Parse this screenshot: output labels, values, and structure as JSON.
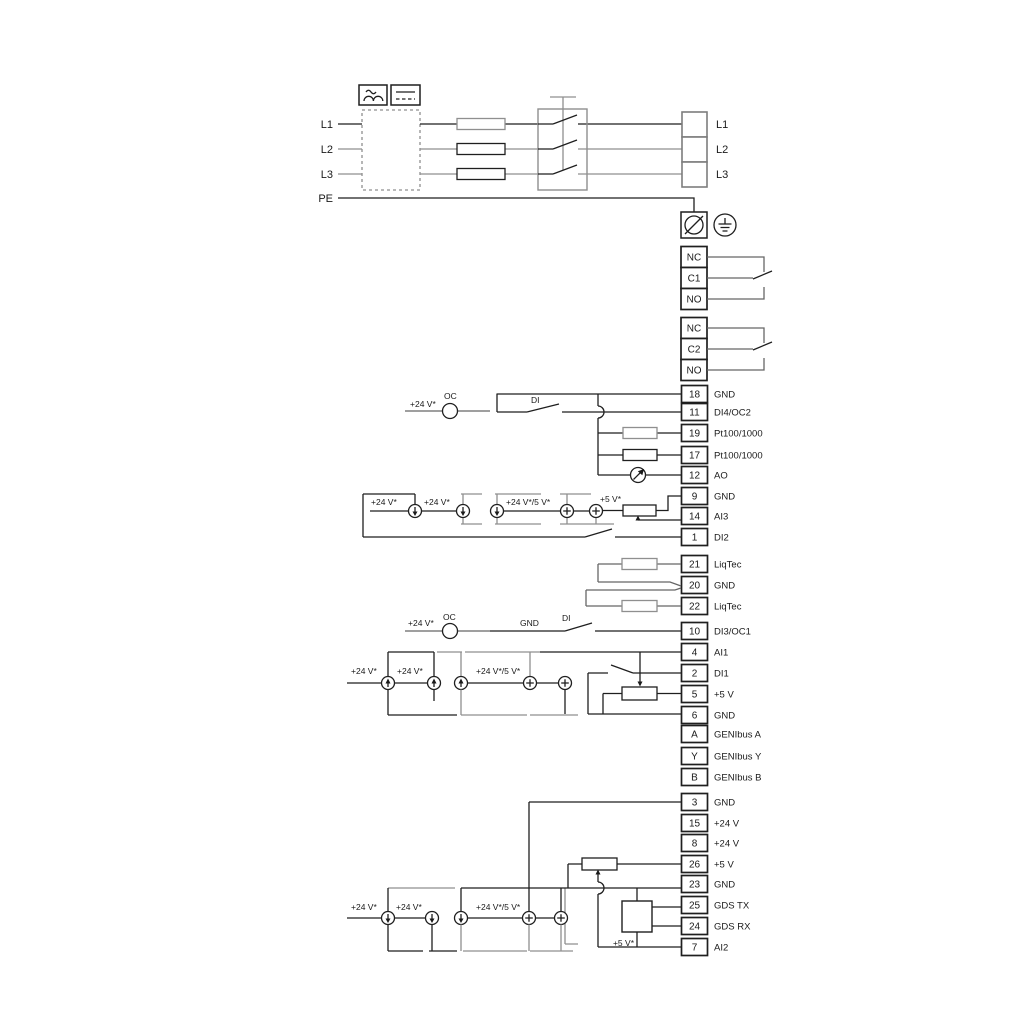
{
  "power": {
    "left_labels": [
      "L1",
      "L2",
      "L3",
      "PE"
    ],
    "right_labels": [
      "L1",
      "L2",
      "L3"
    ]
  },
  "relays": [
    {
      "rows": [
        "NC",
        "C1",
        "NO"
      ]
    },
    {
      "rows": [
        "NC",
        "C2",
        "NO"
      ]
    }
  ],
  "terminals": {
    "group1": [
      {
        "num": "18",
        "label": "GND"
      },
      {
        "num": "11",
        "label": "DI4/OC2"
      },
      {
        "num": "19",
        "label": "Pt100/1000"
      },
      {
        "num": "17",
        "label": "Pt100/1000"
      },
      {
        "num": "12",
        "label": "AO"
      },
      {
        "num": "9",
        "label": "GND"
      },
      {
        "num": "14",
        "label": "AI3"
      },
      {
        "num": "1",
        "label": "DI2"
      }
    ],
    "liqtec": [
      {
        "num": "21",
        "label": "LiqTec"
      },
      {
        "num": "20",
        "label": "GND"
      },
      {
        "num": "22",
        "label": "LiqTec"
      }
    ],
    "io": [
      {
        "num": "10",
        "label": "DI3/OC1"
      },
      {
        "num": "4",
        "label": "AI1"
      },
      {
        "num": "2",
        "label": "DI1"
      },
      {
        "num": "5",
        "label": "+5 V"
      },
      {
        "num": "6",
        "label": "GND"
      },
      {
        "num": "A",
        "label": "GENIbus A"
      },
      {
        "num": "Y",
        "label": "GENIbus Y"
      },
      {
        "num": "B",
        "label": "GENIbus B"
      }
    ],
    "bottom": [
      {
        "num": "3",
        "label": "GND"
      },
      {
        "num": "15",
        "label": "+24 V"
      },
      {
        "num": "8",
        "label": "+24 V"
      },
      {
        "num": "26",
        "label": "+5 V"
      },
      {
        "num": "23",
        "label": "GND"
      },
      {
        "num": "25",
        "label": "GDS TX"
      },
      {
        "num": "24",
        "label": "GDS RX"
      },
      {
        "num": "7",
        "label": "AI2"
      }
    ]
  },
  "ann": {
    "v24": "+24 V*",
    "v245": "+24 V*/5 V*",
    "v5": "+5 V*",
    "oc": "OC",
    "di": "DI",
    "gnd": "GND"
  }
}
